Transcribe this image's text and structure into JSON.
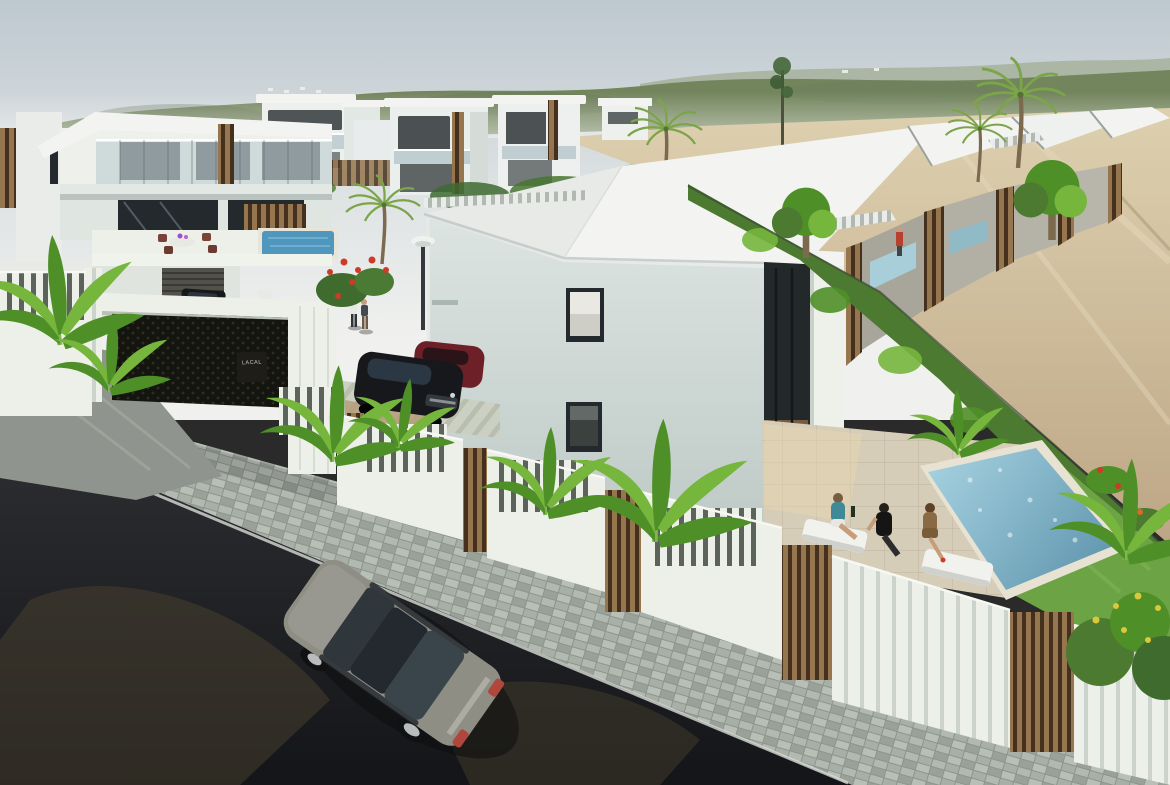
{
  "meta": {
    "type": "photorealistic 3D architectural render",
    "description": "Aerial view of a modern white villa development on a sloping street: two-storey villas with glass balconies, a large central villa, a row of terraced houses with pergola roofs and private pools, white picket fences with dark timber slat panels, banana plants and palms, a grey saloon car on the dark asphalt road, people relaxing beside a pool, green hills and a sandy plain in the distance.",
    "width": 1170,
    "height": 785
  },
  "scene": {
    "gate_sign_text": "LACAL",
    "objects": [
      "white two-storey villas with glass balconies",
      "large central villa with slanted white roof",
      "terraced houses with white pergola roofs",
      "private swimming pool with three people beside it",
      "small terrace pools",
      "white picket fence with dark timber slat panels",
      "black perforated carport gate with small name sign",
      "street lamp",
      "grey saloon car driving on the road",
      "parked dark pickup truck and white scooter",
      "parked dark SUV and dark-red car",
      "two people walking in a driveway",
      "person in red on an upper terrace",
      "outdoor dining set on a villa terrace",
      "banana plants, palm trees and red flowering shrubs",
      "paved sidewalk and dark asphalt road",
      "green wooded hills and sandy plain on the horizon"
    ]
  },
  "colors": {
    "sky_top": "#bdc8cf",
    "sky_mid": "#dde2e3",
    "sky_horizon": "#f0f1ef",
    "hills_near": "#73855d",
    "hills_far": "#a9b39e",
    "sand_light": "#ddd0af",
    "sand_dark": "#bda685",
    "roof_white": "#f3f4f1",
    "roof_shade": "#e7eae6",
    "wall_light": "#dce4e1",
    "wall_cool": "#b9c5c2",
    "glass_dark": "#23292c",
    "balcony_glass": "#b7c8cd",
    "wood_light": "#96764e",
    "wood_dark": "#44301c",
    "gate_dark": "#15150f",
    "fence_white": "#edefe9",
    "fence_gap": "#5c635b",
    "rib_shade": "#ccd3cc",
    "road_dark": "#141518",
    "road_brown": "#49412f",
    "slope_gray": "#8f948e",
    "paver_light": "#b8bfb7",
    "paver_dark": "#9aa199",
    "curb_light": "#d8dcd6",
    "terrace_tile": "#d6cdb9",
    "tile_line": "#bdb4a0",
    "pool_left": "#4f97bd",
    "pool_light": "#a7d3e1",
    "pool_deep": "#5c92ab",
    "lawn_green": "#6ca344",
    "hedge_green": "#4c7a30",
    "leaf_bright": "#76b63c",
    "leaf_dark": "#4f8f28",
    "palm_green": "#7ca449",
    "trunk_brown": "#7c6a4f",
    "car_body": "#8e8e85",
    "car_glass": "#2f373c",
    "car_dark": "#17181b",
    "taillight_red": "#b0473c",
    "skin_tone": "#c79d79",
    "teal_top": "#3f8a96",
    "tan_dress": "#8a6a44",
    "flower_red": "#cd3a26",
    "flower_yellow": "#d9c93a",
    "lamp_pole": "#35393b",
    "sign_bg": "#1e1d18",
    "sign_text": "#c9cabf"
  }
}
